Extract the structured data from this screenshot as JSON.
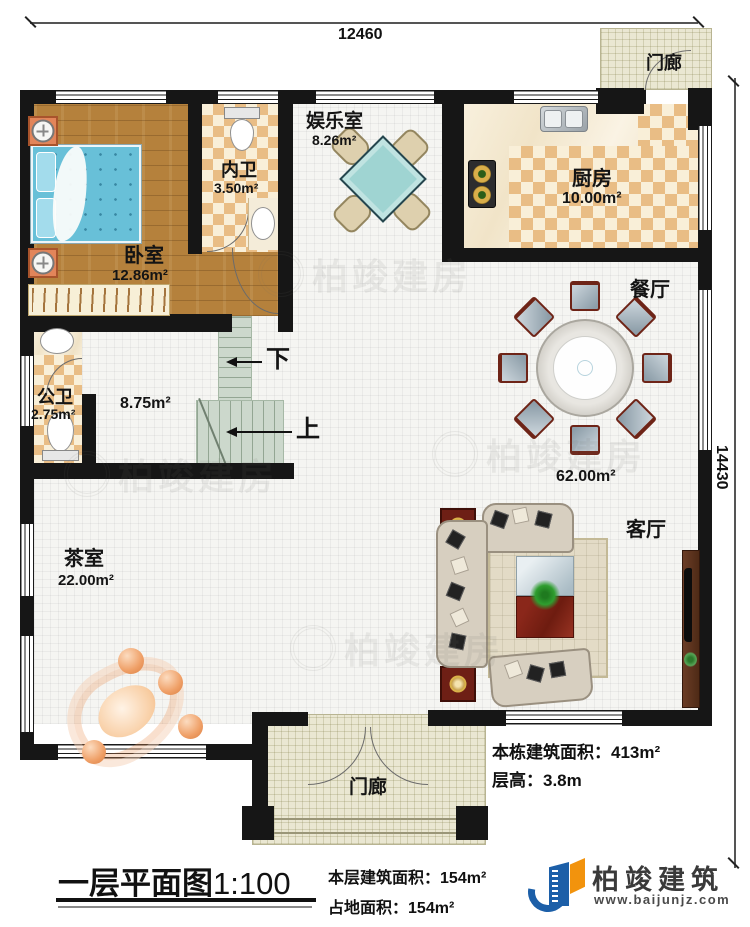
{
  "plan": {
    "dim_top": "12460",
    "dim_right": "14430"
  },
  "rooms": {
    "bedroom": {
      "label": "卧室",
      "area": "12.86m²"
    },
    "ensuite_bath": {
      "label": "内卫",
      "area": "3.50m²"
    },
    "entertainment": {
      "label": "娱乐室",
      "area": "8.26m²"
    },
    "kitchen": {
      "label": "厨房",
      "area": "10.00m²"
    },
    "dining": {
      "label": "餐厅"
    },
    "public_bath": {
      "label": "公卫",
      "area": "2.75m²"
    },
    "stair_hall": {
      "area": "8.75m²"
    },
    "great_hall": {
      "area": "62.00m²"
    },
    "living": {
      "label": "客厅"
    },
    "tea_room": {
      "label": "茶室",
      "area": "22.00m²"
    },
    "porch_top": {
      "label": "门廊"
    },
    "porch_bottom": {
      "label": "门廊"
    }
  },
  "stairs": {
    "down": "下",
    "up": "上"
  },
  "title_block": {
    "title": "一层平面图",
    "scale": "1:100",
    "floor_area_label": "本层建筑面积：",
    "floor_area_value": "154m²",
    "footprint_label": "占地面积：",
    "footprint_value": "154m²",
    "total_area_label": "本栋建筑面积：",
    "total_area_value": "413m²",
    "height_label": "层高：",
    "height_value": "3.8m"
  },
  "logo": {
    "company": "柏竣建筑",
    "website": "www.baijunjz.com"
  },
  "watermark": {
    "text": "柏竣建房"
  },
  "colors": {
    "wall": "#161616",
    "wood": "#b5813c",
    "checker": "#e9bd85",
    "tile": "#f5f5f2",
    "stair": "#ccd8cc",
    "porch": "#eae7d2",
    "table_teal": "#9fd4d2",
    "bed_blue": "#68c0d8",
    "logo_blue": "#1c5fa8",
    "logo_orange": "#f2930d"
  }
}
